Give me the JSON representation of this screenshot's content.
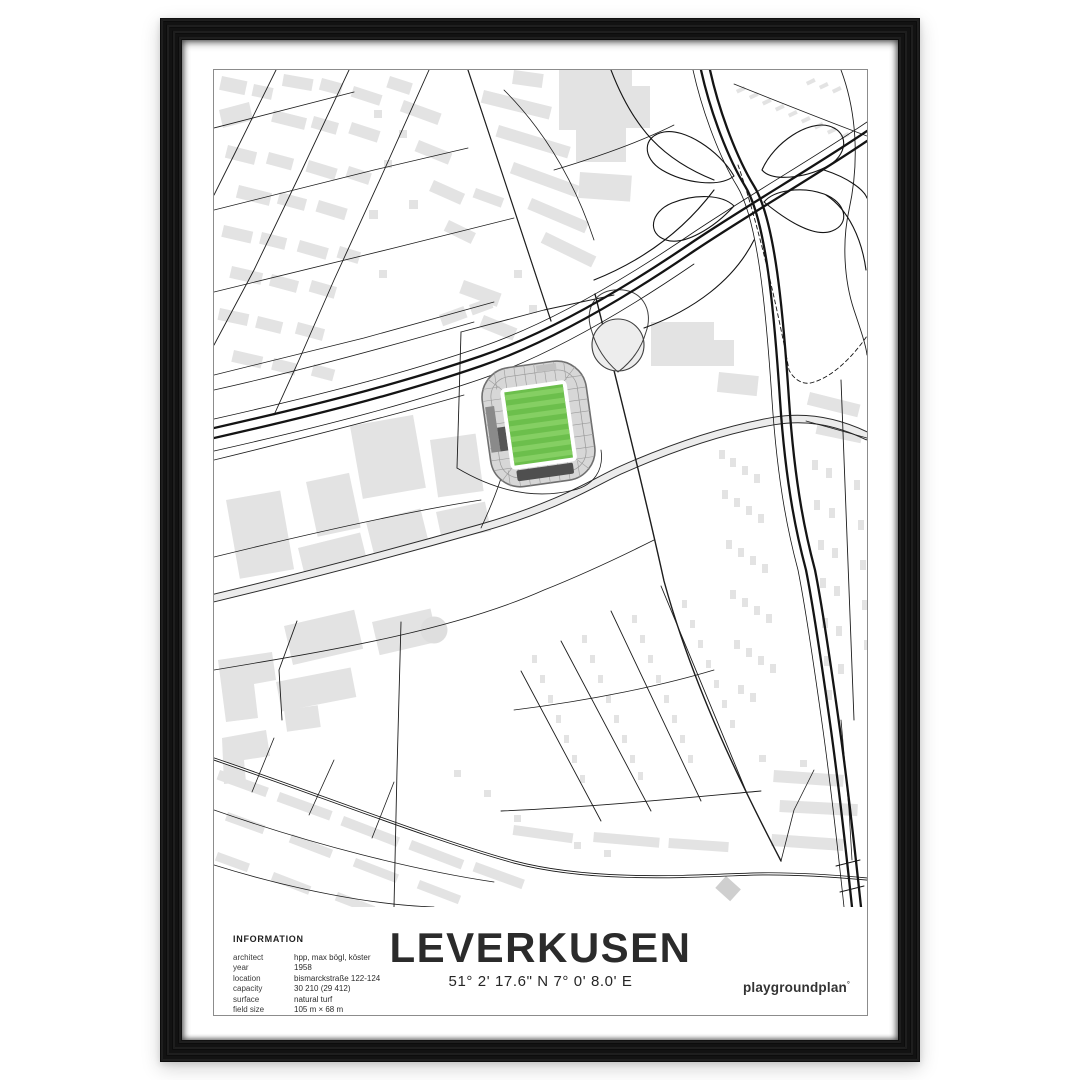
{
  "poster": {
    "title": "LEVERKUSEN",
    "coordinates": "51° 2' 17.6\" N  7° 0' 8.0' E",
    "brand": "playgroundplan",
    "brand_mark": "°",
    "information": {
      "heading": "INFORMATION",
      "rows": [
        {
          "label": "architect",
          "value": "hpp, max bögl, köster"
        },
        {
          "label": "year",
          "value": "1958"
        },
        {
          "label": "location",
          "value": "bismarckstraße 122-124"
        },
        {
          "label": "capacity",
          "value": "30 210 (29 412)"
        },
        {
          "label": "surface",
          "value": "natural turf"
        },
        {
          "label": "field size",
          "value": "105 m × 68 m"
        }
      ]
    },
    "map": {
      "visible_features": [
        "street-grid",
        "railway-corridor",
        "motorway-interchange-cloverleaf",
        "stadium-with-green-pitch",
        "circular-pond"
      ],
      "colors": {
        "building": "#e3e3e3",
        "street_line": "#1d1d1d",
        "major_road_fill": "#ececec",
        "pitch_green": "#6cbf4c",
        "pitch_stripe": "#85cf63",
        "stand_gray": "#d7d7d7",
        "stand_dark": "#4f4f4f",
        "print_border": "#8c8c8c",
        "frame_black": "#141414"
      }
    }
  }
}
